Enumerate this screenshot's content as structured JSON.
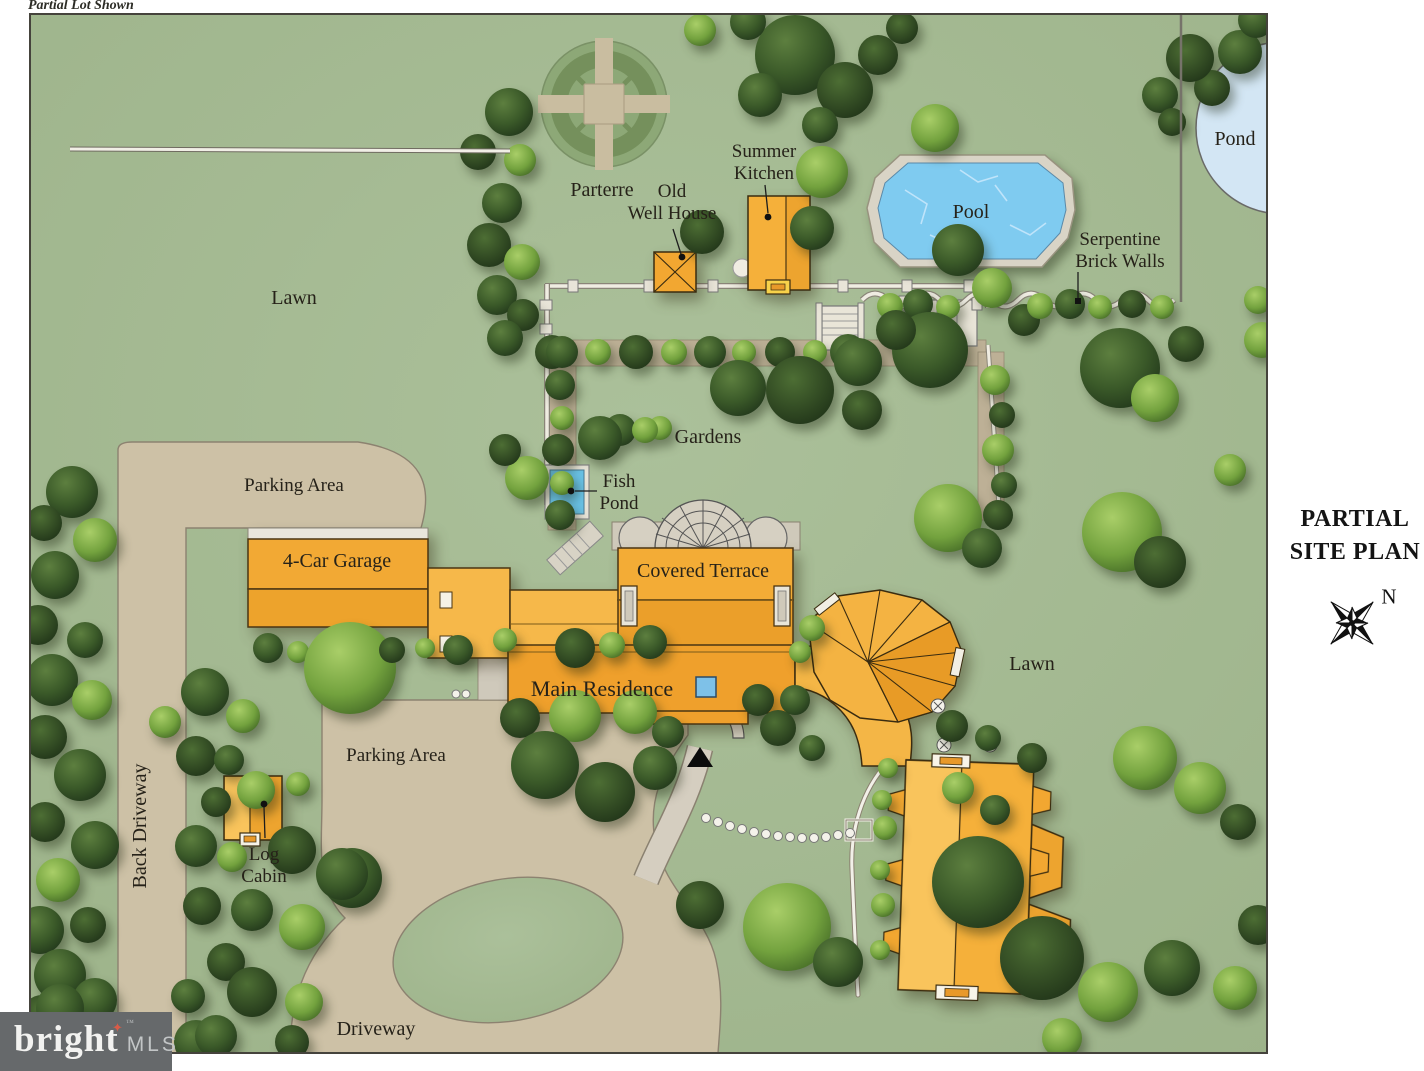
{
  "annotation": "Partial Lot Shown",
  "labels": {
    "parterre": "Parterre",
    "old_well_house_1": "Old",
    "old_well_house_2": "Well House",
    "summer_kitchen_1": "Summer",
    "summer_kitchen_2": "Kitchen",
    "pool": "Pool",
    "pond": "Pond",
    "serpentine_1": "Serpentine",
    "serpentine_2": "Brick Walls",
    "lawn_left": "Lawn",
    "gardens": "Gardens",
    "fish_pond_1": "Fish",
    "fish_pond_2": "Pond",
    "parking_area_top": "Parking Area",
    "four_car_garage": "4-Car Garage",
    "covered_terrace": "Covered Terrace",
    "main_residence": "Main Residence",
    "lawn_right": "Lawn",
    "parking_area_bottom": "Parking Area",
    "log_cabin_1": "Log",
    "log_cabin_2": "Cabin",
    "back_driveway": "Back Driveway",
    "driveway": "Driveway"
  },
  "side_panel": {
    "title_1": "PARTIAL",
    "title_2": "SITE PLAN",
    "compass_label": "N"
  },
  "logo": {
    "brand": "bright",
    "suffix": "MLS",
    "star_icon": "star",
    "tm": "™"
  },
  "colors": {
    "lawn": "#a5ba93",
    "tree_dark": "#33502a",
    "tree_light": "#74a23f",
    "building_orange": "#f2a934",
    "building_light": "#f8c45c",
    "drive_tan": "#cdc1a6",
    "pool_water": "#7fcbf0",
    "pond_water": "#d3e6f4",
    "fish_pond_water": "#6ac2e6",
    "wall_white": "#f0ede2",
    "logo_bg": "#66696b",
    "logo_star": "#d95b47"
  }
}
